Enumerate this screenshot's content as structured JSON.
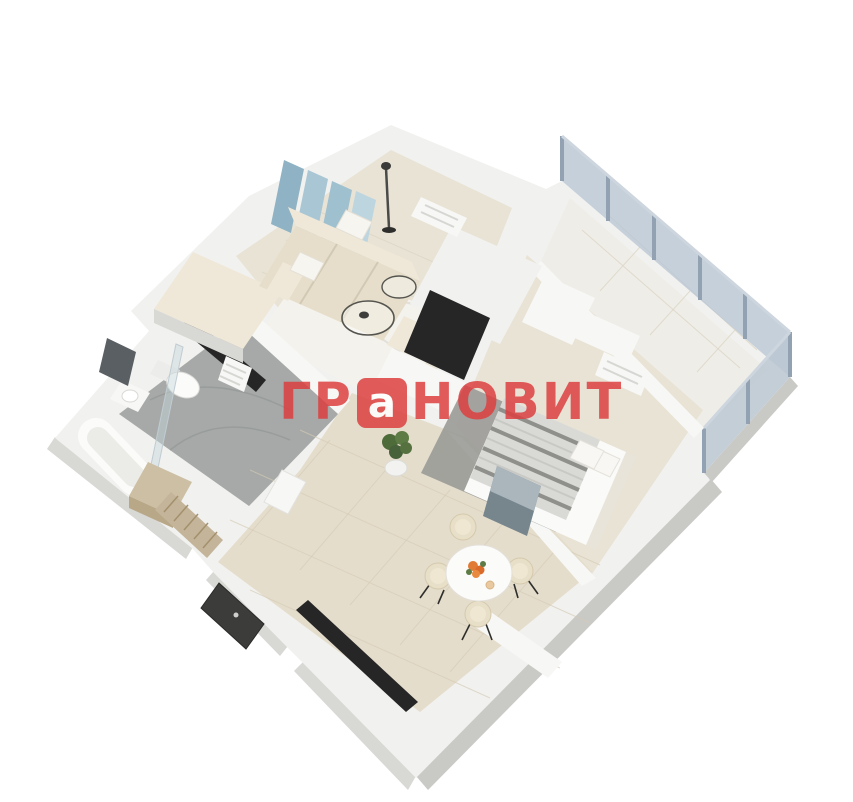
{
  "watermark": {
    "prefix": "ГР",
    "boxed_letter": "а",
    "suffix": "НОВИТ",
    "color": "#dc4040"
  },
  "palette": {
    "bg": "#ffffff",
    "wall_top": "#f1f1ef",
    "wall_inner": "#f7f7f5",
    "wall_side": "#c9c9c6",
    "wall_side2": "#d8d8d5",
    "wood_floor": "#e9e3d5",
    "tile_floor": "#e5ddcc",
    "tile_line": "#d5cbb6",
    "bath_floor": "#a6a9a7",
    "balcony_floor": "#efede8",
    "rug_white": "#f4f2ed",
    "rug_grey": "#9c9c99",
    "glass": "#b9c6d2",
    "glass_frame": "#93a2b2",
    "sofa": "#e6decb",
    "sofa_light": "#efe8d8",
    "bed_white": "#fafaf8",
    "stripe_dark": "#8f8f8c",
    "art_blue": "#9fc0cf",
    "dark": "#262626",
    "door_dark": "#3c3c3a",
    "wood_accent": "#cdbfa3",
    "plant_green": "#55703f",
    "accent_orange": "#e07a35",
    "watermark_red": "#dc4040"
  },
  "scene": {
    "description": "3D isometric dollhouse render of a one-bedroom apartment floor plan on white background",
    "rooms": [
      {
        "name": "living-room",
        "furniture": [
          "beige-sofa",
          "wall-art-panels",
          "floor-lamp",
          "round-coffee-tables",
          "tv-unit",
          "radiator",
          "storage-cabinet",
          "white-marble-rug"
        ]
      },
      {
        "name": "bedroom",
        "furniture": [
          "double-bed-striped-blanket",
          "grey-rug",
          "wall-art",
          "radiator",
          "wardrobe",
          "low-cabinet"
        ]
      },
      {
        "name": "balcony",
        "furniture": [
          "glazed-window-wall",
          "tiled-floor"
        ]
      },
      {
        "name": "bathroom",
        "furniture": [
          "bathtub",
          "toilet",
          "sink-vanity",
          "mirror",
          "towel-radiator",
          "shower-screen",
          "dark-niche"
        ]
      },
      {
        "name": "hallway-dining",
        "furniture": [
          "round-dining-table",
          "four-chairs",
          "orange-flowers",
          "potted-plant",
          "entrance-door",
          "slatted-coat-rack",
          "wood-cabinet",
          "dark-wall-niche"
        ]
      }
    ]
  }
}
